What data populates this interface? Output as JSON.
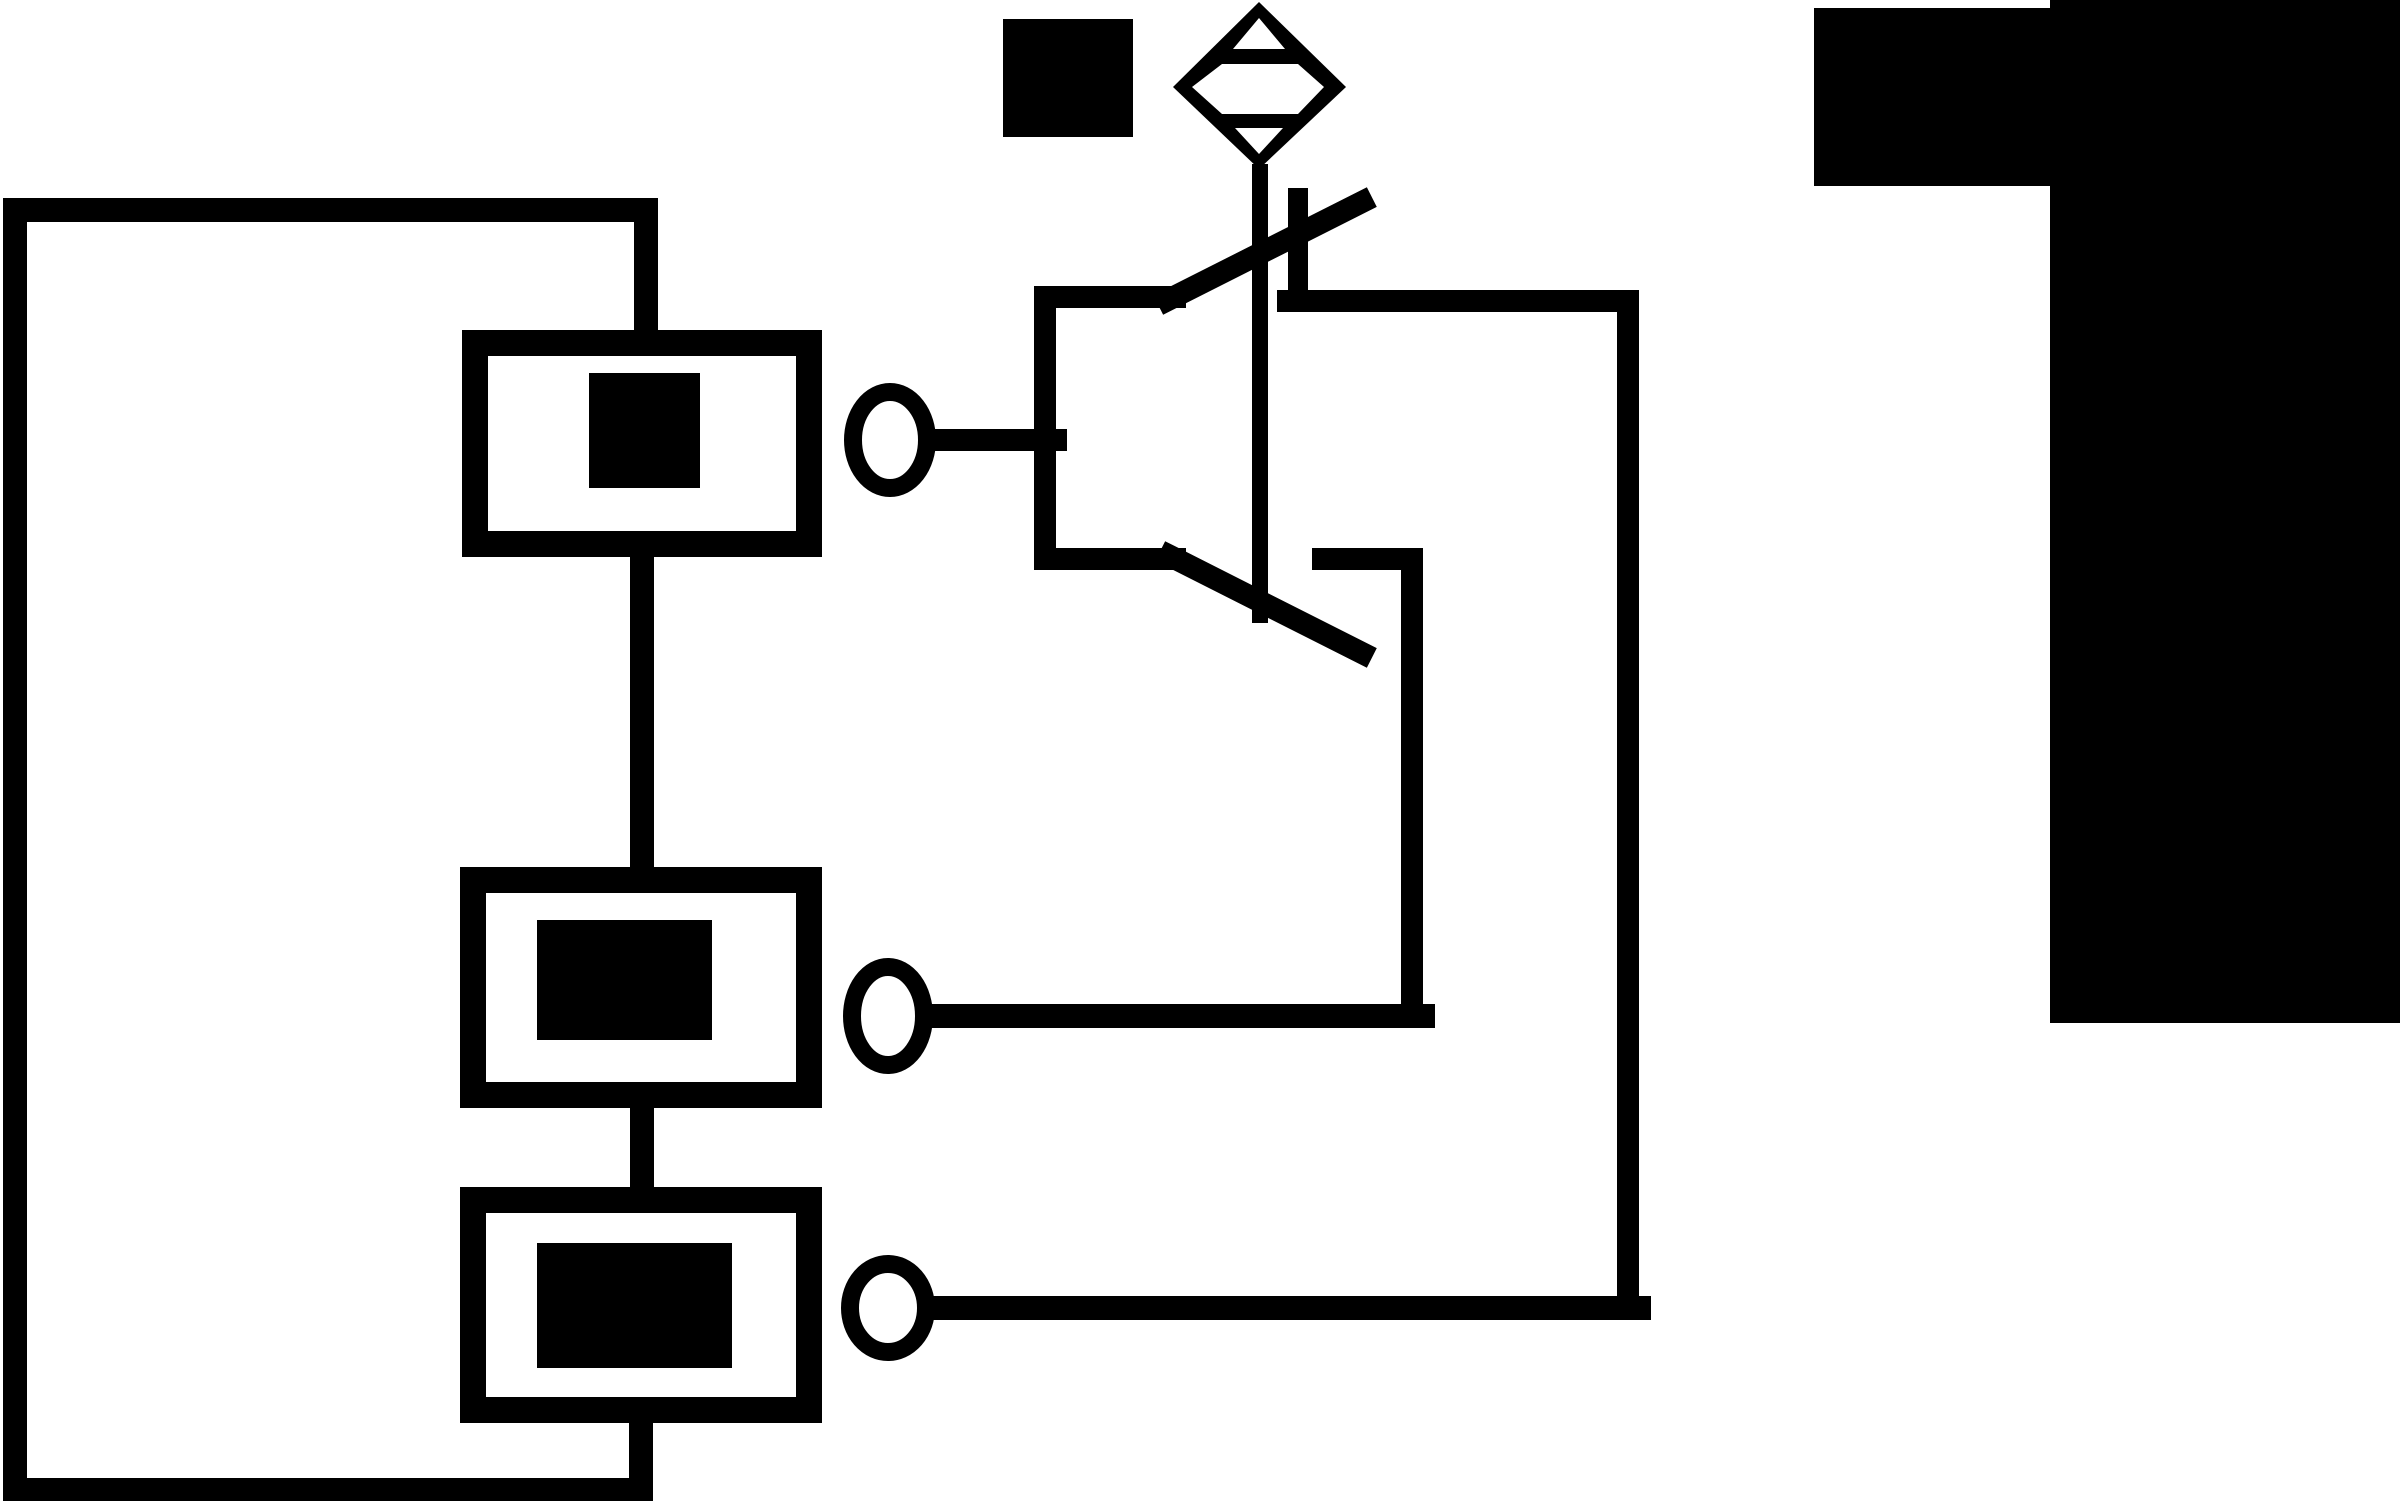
{
  "canvas": {
    "width": 2400,
    "height": 1501,
    "background_color": "#ffffff",
    "ink_color": "#000000",
    "title": "schematic-circuit-figure"
  },
  "diagram": {
    "description": "Black and white schematic: outer wire loop with three series component boxes (solid fill marks), three terminal circles wired to a changeover switch symbol, dashed actuator line to a diamond valve/actuator symbol, black legend square, and two redacted black label blocks at top right.",
    "shapes": [
      {
        "kind": "polyline",
        "name": "circuit-loop-wire",
        "points": "646,335 646,210 15,210 15,1490 641,1490 641,1415",
        "stroke": "#000000",
        "strokeWidth": 24,
        "fill": "none"
      },
      {
        "kind": "rect",
        "name": "component-box-1",
        "x": 475,
        "y": 343,
        "w": 334,
        "h": 201,
        "stroke": "#000000",
        "strokeWidth": 26,
        "fill": "none"
      },
      {
        "kind": "rect",
        "name": "component-box-1-fill-mark",
        "x": 589,
        "y": 373,
        "w": 111,
        "h": 115,
        "fill": "#000000"
      },
      {
        "kind": "line",
        "name": "wire-box1-to-box2",
        "x1": 642,
        "y1": 557,
        "x2": 642,
        "y2": 880,
        "stroke": "#000000",
        "strokeWidth": 24
      },
      {
        "kind": "rect",
        "name": "component-box-2",
        "x": 473,
        "y": 880,
        "w": 336,
        "h": 215,
        "stroke": "#000000",
        "strokeWidth": 26,
        "fill": "none"
      },
      {
        "kind": "rect",
        "name": "component-box-2-fill-mark",
        "x": 537,
        "y": 920,
        "w": 175,
        "h": 120,
        "fill": "#000000"
      },
      {
        "kind": "line",
        "name": "wire-box2-to-box3",
        "x1": 642,
        "y1": 1095,
        "x2": 642,
        "y2": 1200,
        "stroke": "#000000",
        "strokeWidth": 24
      },
      {
        "kind": "rect",
        "name": "component-box-3",
        "x": 473,
        "y": 1200,
        "w": 336,
        "h": 210,
        "stroke": "#000000",
        "strokeWidth": 26,
        "fill": "none"
      },
      {
        "kind": "rect",
        "name": "component-box-3-fill-mark",
        "x": 537,
        "y": 1243,
        "w": 195,
        "h": 125,
        "fill": "#000000"
      },
      {
        "kind": "ellipse",
        "name": "terminal-circle-1",
        "cx": 890,
        "cy": 440,
        "rx": 37,
        "ry": 48,
        "stroke": "#000000",
        "strokeWidth": 18,
        "fill": "none"
      },
      {
        "kind": "ellipse",
        "name": "terminal-circle-2",
        "cx": 888,
        "cy": 1016,
        "rx": 36,
        "ry": 49,
        "stroke": "#000000",
        "strokeWidth": 18,
        "fill": "none"
      },
      {
        "kind": "ellipse",
        "name": "terminal-circle-3",
        "cx": 888,
        "cy": 1308,
        "rx": 38,
        "ry": 44,
        "stroke": "#000000",
        "strokeWidth": 18,
        "fill": "none"
      },
      {
        "kind": "line",
        "name": "wire-terminal1-to-switch",
        "x1": 930,
        "y1": 440,
        "x2": 1056,
        "y2": 440,
        "stroke": "#000000",
        "strokeWidth": 22
      },
      {
        "kind": "polyline",
        "name": "switch-frame",
        "points": "1175,297 1045,297 1045,559 1175,559",
        "stroke": "#000000",
        "strokeWidth": 22,
        "fill": "none"
      },
      {
        "kind": "line",
        "name": "switch-blade-upper",
        "x1": 1168,
        "y1": 300,
        "x2": 1362,
        "y2": 202,
        "stroke": "#000000",
        "strokeWidth": 22
      },
      {
        "kind": "line",
        "name": "switch-contact-post",
        "x1": 1298,
        "y1": 198,
        "x2": 1298,
        "y2": 301,
        "stroke": "#000000",
        "strokeWidth": 20
      },
      {
        "kind": "line",
        "name": "switch-right-wire-horizontal",
        "x1": 1288,
        "y1": 301,
        "x2": 1628,
        "y2": 301,
        "stroke": "#000000",
        "strokeWidth": 22
      },
      {
        "kind": "line",
        "name": "switch-blade-lower",
        "x1": 1170,
        "y1": 556,
        "x2": 1362,
        "y2": 653,
        "stroke": "#000000",
        "strokeWidth": 22
      },
      {
        "kind": "line",
        "name": "actuator-dashed-link",
        "x1": 1260,
        "y1": 172,
        "x2": 1260,
        "y2": 615,
        "stroke": "#000000",
        "strokeWidth": 16,
        "dash": "26 14"
      },
      {
        "kind": "line",
        "name": "contact-stub-horizontal",
        "x1": 1323,
        "y1": 559,
        "x2": 1412,
        "y2": 559,
        "stroke": "#000000",
        "strokeWidth": 22
      },
      {
        "kind": "line",
        "name": "wire-stub-down-vertical",
        "x1": 1412,
        "y1": 559,
        "x2": 1412,
        "y2": 1016,
        "stroke": "#000000",
        "strokeWidth": 22
      },
      {
        "kind": "line",
        "name": "wire-terminal2-horizontal",
        "x1": 928,
        "y1": 1016,
        "x2": 1423,
        "y2": 1016,
        "stroke": "#000000",
        "strokeWidth": 24
      },
      {
        "kind": "line",
        "name": "wire-right-vertical",
        "x1": 1628,
        "y1": 301,
        "x2": 1628,
        "y2": 1308,
        "stroke": "#000000",
        "strokeWidth": 22
      },
      {
        "kind": "line",
        "name": "wire-terminal3-horizontal",
        "x1": 930,
        "y1": 1308,
        "x2": 1639,
        "y2": 1308,
        "stroke": "#000000",
        "strokeWidth": 24
      },
      {
        "kind": "polygon",
        "name": "actuator-diamond-symbol",
        "points": "1259,2 1346,87 1259,169 1173,87",
        "fill": "#000000"
      },
      {
        "kind": "polygon",
        "name": "diamond-inner-top-triangle",
        "points": "1259,18 1233,49 1285,49",
        "fill": "#ffffff"
      },
      {
        "kind": "polygon",
        "name": "diamond-inner-hexagon",
        "points": "1192,87 1222,64 1298,64 1324,87 1298,114 1222,114",
        "fill": "#ffffff"
      },
      {
        "kind": "polygon",
        "name": "diamond-inner-bottom-triangle",
        "points": "1235,128 1283,128 1259,154",
        "fill": "#ffffff"
      },
      {
        "kind": "rect",
        "name": "legend-black-square",
        "x": 1003,
        "y": 19,
        "w": 130,
        "h": 118,
        "fill": "#000000"
      },
      {
        "kind": "rect",
        "name": "redacted-label-small",
        "x": 1814,
        "y": 8,
        "w": 238,
        "h": 178,
        "fill": "#000000"
      },
      {
        "kind": "rect",
        "name": "redacted-label-large",
        "x": 2050,
        "y": 0,
        "w": 350,
        "h": 1023,
        "fill": "#000000"
      }
    ]
  }
}
